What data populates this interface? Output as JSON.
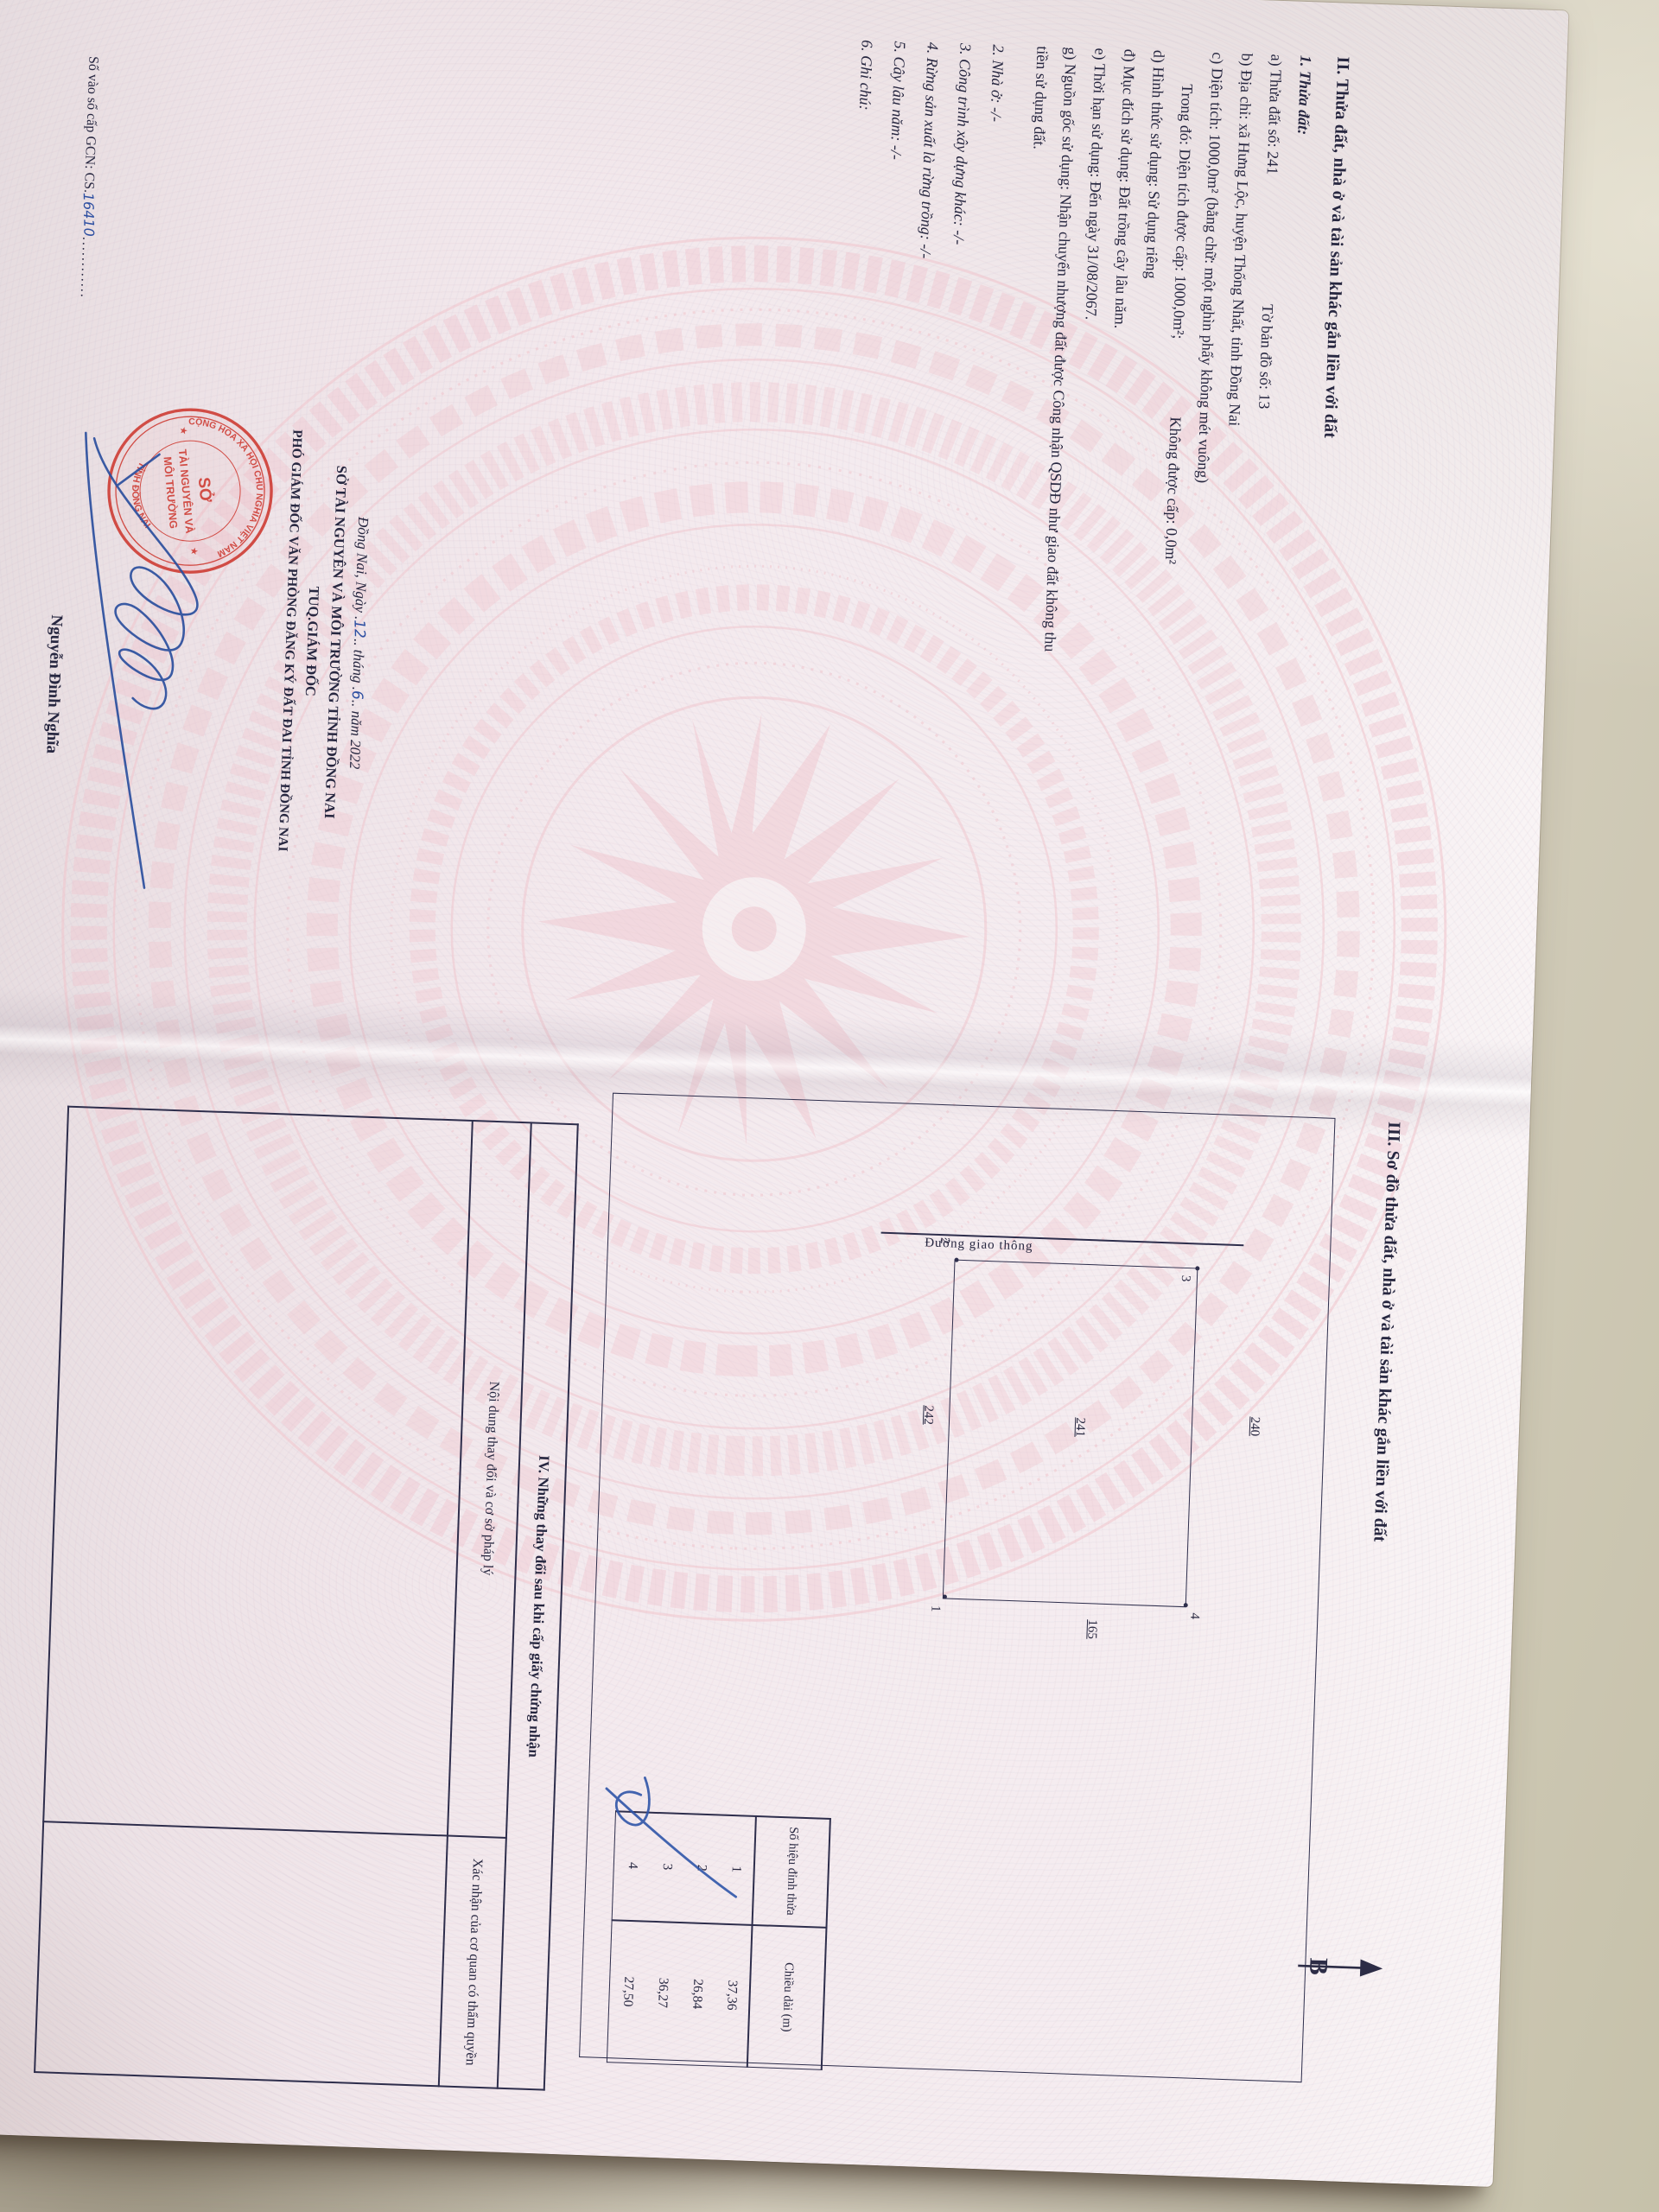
{
  "document": {
    "page2": {
      "section2_heading": "II. Thửa đất, nhà ở và tài sản khác gắn liền với đất",
      "parcel_heading": "1. Thửa đất:",
      "lines": [
        {
          "t1": "a) Thửa đất số: 241",
          "t2": "Tờ bản đồ số: 13"
        },
        {
          "t1": "b) Địa chỉ: xã Hưng Lộc, huyện Thống Nhất, tỉnh Đồng Nai"
        },
        {
          "t1": "c) Diện tích: 1000,0m² (bằng chữ: một nghìn phẩy không mét vuông)"
        },
        {
          "t1": "Trong đó: Diện tích được cấp: 1000,0m²;",
          "t2": "Không được cấp: 0,0m²"
        },
        {
          "t1": "d) Hình thức sử dụng: Sử dụng riêng"
        },
        {
          "t1": "đ) Mục đích sử dụng: Đất trồng cây lâu năm."
        },
        {
          "t1": "e) Thời hạn sử dụng: Đến ngày 31/08/2067."
        },
        {
          "t1": "g) Nguồn gốc sử dụng: Nhận chuyển nhượng đất được Công nhận QSDĐ như giao đất không thu"
        },
        {
          "t1": "tiền sử dụng đất."
        }
      ],
      "items": [
        "2. Nhà ở: -/-",
        "3. Công trình xây dựng khác: -/-",
        "4. Rừng sản xuất là rừng trồng: -/-",
        "5. Cây lâu năm: -/-",
        "6. Ghi chú:"
      ],
      "issue": {
        "prefix": "Đồng Nai, Ngày .",
        "day": "12",
        "mid1": ".. tháng .",
        "month": "6",
        "suffix": ".. năm 2022"
      },
      "agency": "SỞ TÀI NGUYÊN VÀ MÔI TRƯỜNG TỈNH ĐỒNG NAI",
      "signer_title1": "TUQ.GIÁM ĐỐC",
      "signer_title2": "PHÓ GIÁM ĐỐC VĂN PHÒNG ĐĂNG KÝ ĐẤT ĐAI TỈNH ĐỒNG NAI",
      "signer_name": "Nguyễn Đình Nghĩa",
      "book_entry_label": "Số vào sổ cấp GCN: CS.",
      "book_entry_value": "16410",
      "book_entry_dots": "............",
      "stamp": {
        "arc_top": "CỘNG HÒA XÃ HỘI CHỦ NGHĨA VIỆT NAM",
        "arc_bottom": "TỈNH ĐỒNG NAI",
        "center1": "SỞ",
        "center2": "TÀI NGUYÊN VÀ",
        "center3": "MÔI TRƯỜNG",
        "star": "★",
        "color": "#cf4038"
      }
    },
    "page3": {
      "section3_heading": "III. Sơ đồ thửa đất, nhà ở và tài sản khác gắn liền với đất",
      "diagram": {
        "north_label": "B",
        "road_label": "Đường giao thông",
        "parcel_number": "241",
        "neighbor_top": "240",
        "neighbor_bottom": "242",
        "neighbor_right": "165",
        "v1": "1",
        "v2": "2",
        "v3": "3",
        "v4": "4"
      },
      "vertex_table": {
        "col1": "Số hiệu đỉnh thửa",
        "col2": "Chiều dài (m)",
        "rows": [
          [
            "1",
            "37,36"
          ],
          [
            "2",
            "26,84"
          ],
          [
            "3",
            "36,27"
          ],
          [
            "4",
            "27,50"
          ]
        ]
      },
      "section4_heading": "IV. Những thay đổi sau khi cấp giấy chứng nhận",
      "col_content": "Nội dung thay đổi và cơ sở pháp lý",
      "col_confirm": "Xác nhận của cơ quan có thẩm quyền"
    },
    "ink_color": "#272740",
    "signature_color": "#2b4f9e",
    "paper_color": "#f5edf0",
    "background_color": "#d2ccba"
  }
}
